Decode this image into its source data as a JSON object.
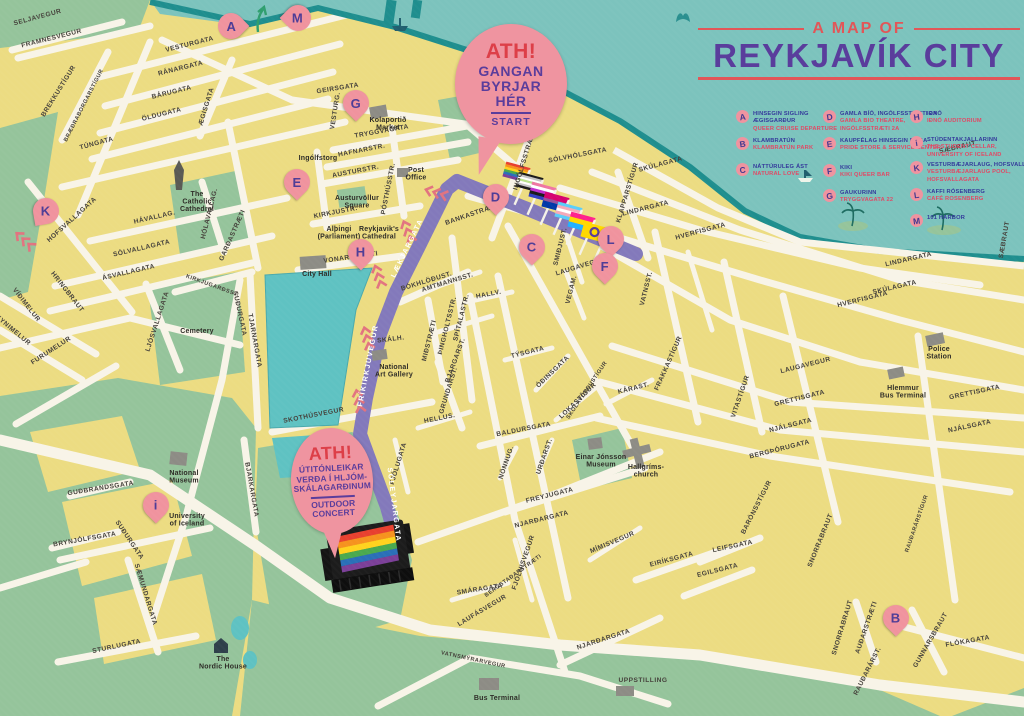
{
  "title": {
    "pre": "A MAP OF",
    "main": "REYKJAVÍK CITY"
  },
  "callouts": {
    "start": {
      "ath": "ATH!",
      "l1": "GANGAN",
      "l2": "BYRJAR",
      "l3": "HÉR",
      "foot": "START"
    },
    "concert": {
      "ath": "ATH!",
      "l1": "ÚTITÓNLEIKAR",
      "l2": "VERÐA Í HLJÓM-",
      "l3": "SKÁLAGARÐINUM",
      "f1": "OUTDOOR",
      "f2": "CONCERT"
    }
  },
  "legend": {
    "entries": [
      {
        "letter": "A",
        "x": 736,
        "y": 110,
        "is": [
          "HINSEGIN SIGLING",
          "ÆGISGARÐUR"
        ],
        "en": [
          "QUEER CRUISE DEPARTURE"
        ]
      },
      {
        "letter": "B",
        "x": 736,
        "y": 137,
        "is": [
          "KLAMBRATÚN"
        ],
        "en": [
          "KLAMBRATÚN PARK"
        ]
      },
      {
        "letter": "C",
        "x": 736,
        "y": 163,
        "is": [
          "NÁTTÚRULEG ÁST"
        ],
        "en": [
          "NATURAL LOVE"
        ]
      },
      {
        "letter": "D",
        "x": 823,
        "y": 110,
        "is": [
          "GAMLA BÍÓ, INGÓLFSSTRÆTI 2A"
        ],
        "en": [
          "GAMLA BIO THEATRE,",
          "INGÓLFSSTRÆTI 2A"
        ]
      },
      {
        "letter": "E",
        "x": 823,
        "y": 137,
        "is": [
          "KAUPFÉLAG HINSEGIN DAGA"
        ],
        "en": [
          "PRIDE STORE & SERVICE CENTER"
        ]
      },
      {
        "letter": "F",
        "x": 823,
        "y": 164,
        "is": [
          "KIKI"
        ],
        "en": [
          "KIKI QUEER BAR"
        ]
      },
      {
        "letter": "G",
        "x": 823,
        "y": 189,
        "is": [
          "GAUKURINN"
        ],
        "en": [
          "TRYGGVAGATA 22"
        ]
      },
      {
        "letter": "H",
        "x": 910,
        "y": 110,
        "is": [
          "IÐNÓ"
        ],
        "en": [
          "IÐNÓ AUDITORIUM"
        ]
      },
      {
        "letter": "i",
        "x": 910,
        "y": 136,
        "is": [
          "STÚDENTAKJALLARINN"
        ],
        "en": [
          "THE STUDENT CELLAR,",
          "UNIVERSITY OF ICELAND"
        ]
      },
      {
        "letter": "K",
        "x": 910,
        "y": 161,
        "is": [
          "VESTURBÆJARLAUG, HOFSVALLAGATA"
        ],
        "en": [
          "VESTURBÆJARLAUG POOL,",
          "HOFSVALLAGATA"
        ]
      },
      {
        "letter": "L",
        "x": 910,
        "y": 188,
        "is": [
          "KAFFI RÓSENBERG"
        ],
        "en": [
          "CAFÉ ROSENBERG"
        ]
      },
      {
        "letter": "M",
        "x": 910,
        "y": 214,
        "is": [
          "101 HARBOR"
        ],
        "en": []
      }
    ]
  },
  "map": {
    "pins": [
      [
        "A",
        231,
        26,
        "right"
      ],
      [
        "M",
        298,
        18,
        "left"
      ],
      [
        "G",
        356,
        103,
        "down"
      ],
      [
        "E",
        297,
        182,
        "down"
      ],
      [
        "H",
        361,
        252,
        "down"
      ],
      [
        "D",
        496,
        197,
        "down"
      ],
      [
        "C",
        532,
        247,
        "down"
      ],
      [
        "L",
        611,
        239,
        "down"
      ],
      [
        "F",
        605,
        266,
        "down"
      ],
      [
        "K",
        46,
        211,
        "down-left"
      ],
      [
        "i",
        156,
        505,
        "down"
      ],
      [
        "B",
        896,
        618,
        "down"
      ]
    ],
    "route_labels": [
      [
        "LÆKJARGATA",
        409,
        249,
        -64
      ],
      [
        "FRÍKIRKJUVEGUR",
        370,
        366,
        -79
      ],
      [
        "SÓLEYJARGATA",
        392,
        505,
        83
      ]
    ],
    "street_labels": [
      [
        "SELJAVEGUR",
        38,
        19,
        -15
      ],
      [
        "FRAMNESVEGUR",
        52,
        40,
        -14
      ],
      [
        "VESTURGATA",
        190,
        46,
        -14
      ],
      [
        "RÁNARGATA",
        181,
        70,
        -14
      ],
      [
        "BÁRUGATA",
        172,
        94,
        -14
      ],
      [
        "ÖLDUGATA",
        162,
        116,
        -14
      ],
      [
        "ÆGISGATA",
        208,
        107,
        -73
      ],
      [
        "BREKKUSTÍGUR",
        60,
        92,
        -58
      ],
      [
        "BRÆÐRABORGARSTÍGUR",
        85,
        106,
        -63
      ],
      [
        "TÚNGATA",
        97,
        145,
        -15
      ],
      [
        "HOFSVALLAGATA",
        73,
        221,
        -42
      ],
      [
        "HÁVALLAG.",
        155,
        219,
        -13
      ],
      [
        "HÓLAVALLAG.",
        211,
        214,
        -76
      ],
      [
        "GARÐASTRÆTI",
        234,
        236,
        -66
      ],
      [
        "SÓLVALLAGATA",
        142,
        250,
        -13
      ],
      [
        "ÁSVALLAGATA",
        129,
        274,
        -13
      ],
      [
        "LJÓSVALLAGATA",
        159,
        322,
        -72
      ],
      [
        "KIRKJUGARÐSST.",
        212,
        287,
        20
      ],
      [
        "SUÐURGATA",
        238,
        314,
        78
      ],
      [
        "TJARNARGATA",
        253,
        341,
        80
      ],
      [
        "VÍÐIMELUR",
        25,
        306,
        52
      ],
      [
        "REYNIMELUR",
        10,
        330,
        40
      ],
      [
        "FURUMELUR",
        52,
        352,
        -33
      ],
      [
        "HRINGBRAUT",
        66,
        293,
        52
      ],
      [
        "GEIRSGATA",
        338,
        90,
        -9
      ],
      [
        "TRYGGVAGATA",
        382,
        133,
        -10
      ],
      [
        "HAFNARSTR.",
        362,
        152,
        -11
      ],
      [
        "AUSTURSTR.",
        356,
        173,
        -11
      ],
      [
        "PÓSTHÚSSTR.",
        390,
        189,
        -79
      ],
      [
        "VESTURG.",
        337,
        111,
        -81
      ],
      [
        "KIRKJUSTR.",
        336,
        214,
        -11
      ],
      [
        "VONARSTRÆTI",
        351,
        259,
        -8
      ],
      [
        "INGÓLFSSTRÆTI",
        526,
        161,
        -73
      ],
      [
        "SÓLVHÓLSGATA",
        578,
        157,
        -11
      ],
      [
        "SKÚLAGATA",
        661,
        166,
        -15
      ],
      [
        "SKÚLAGATA",
        895,
        289,
        -13
      ],
      [
        "SÆBRAUT",
        958,
        149,
        -13
      ],
      [
        "SÆBRAUT",
        1006,
        240,
        -80
      ],
      [
        "LINDARGATA",
        646,
        210,
        -14
      ],
      [
        "LINDARGATA",
        909,
        261,
        -13
      ],
      [
        "HVERFISGATA",
        701,
        233,
        -15
      ],
      [
        "HVERFISGATA",
        863,
        301,
        -14
      ],
      [
        "KLAPPARSTÍGUR",
        629,
        193,
        -73
      ],
      [
        "BANKASTRÆTI",
        472,
        216,
        -19
      ],
      [
        "AMTMANNSST.",
        448,
        284,
        -17
      ],
      [
        "SMIÐJUST.",
        562,
        247,
        -76
      ],
      [
        "LAUGAVEGUR",
        581,
        268,
        -17
      ],
      [
        "LAUGAVEGUR",
        806,
        367,
        -14
      ],
      [
        "VEGAM.",
        573,
        290,
        -76
      ],
      [
        "VATNSST.",
        648,
        289,
        -76
      ],
      [
        "HALLV.",
        489,
        296,
        -11
      ],
      [
        "SKÓLAVÖRÐUSTÍGUR",
        588,
        391,
        -56
      ],
      [
        "ÞINGHOLTSSTR.",
        449,
        326,
        -76
      ],
      [
        "MIÐSTRÆTI",
        431,
        341,
        -76
      ],
      [
        "SPÍTALASTR.",
        463,
        318,
        -76
      ],
      [
        "BÓKHLÖÐUST.",
        427,
        283,
        -17
      ],
      [
        "BJARGARST.",
        457,
        361,
        -70
      ],
      [
        "GRUNDARST.",
        450,
        391,
        -73
      ],
      [
        "HELLUS.",
        440,
        420,
        -11
      ],
      [
        "SKÁLH.",
        391,
        341,
        -7
      ],
      [
        "SKOTHÚSVEGUR",
        314,
        417,
        -11
      ],
      [
        "TÝSGATA",
        528,
        354,
        -14
      ],
      [
        "ÓÐINSGATA",
        554,
        373,
        -44
      ],
      [
        "LOKASTÍGUR",
        579,
        402,
        -44
      ],
      [
        "BALDURSGATA",
        524,
        431,
        -11
      ],
      [
        "NÖNNUG.",
        508,
        463,
        -71
      ],
      [
        "URÐARST.",
        546,
        457,
        -71
      ],
      [
        "FREYJUGATA",
        550,
        497,
        -14
      ],
      [
        "NJARÐARGATA",
        542,
        521,
        -14
      ],
      [
        "NJARÐARGATA",
        604,
        641,
        -18
      ],
      [
        "FJÓLUGATA",
        400,
        464,
        -73
      ],
      [
        "FJÖLNISVEGUR",
        525,
        563,
        -71
      ],
      [
        "SMÁRAGATA",
        480,
        591,
        -9
      ],
      [
        "LAUFÁSVEGUR",
        483,
        612,
        -31
      ],
      [
        "BERGSTAÐARSTRÆTI",
        514,
        577,
        -36
      ],
      [
        "MÍMISVEGUR",
        613,
        544,
        -23
      ],
      [
        "EIRÍKSGATA",
        672,
        561,
        -15
      ],
      [
        "EGILSGATA",
        718,
        572,
        -14
      ],
      [
        "LEIFSGATA",
        733,
        548,
        -12
      ],
      [
        "BARÓNSSTÍGUR",
        758,
        508,
        -63
      ],
      [
        "SNORRABRAUT",
        822,
        541,
        -68
      ],
      [
        "SNORRABRAUT",
        844,
        628,
        -73
      ],
      [
        "RAUÐARÁRSTÍGUR",
        918,
        524,
        -71
      ],
      [
        "RAUÐARÁRST.",
        869,
        672,
        -63
      ],
      [
        "GUNNARSBRAUT",
        932,
        641,
        -60
      ],
      [
        "AUÐARSTRÆTI",
        868,
        628,
        -71
      ],
      [
        "FLÓKAGATA",
        968,
        643,
        -10
      ],
      [
        "KÁRAST.",
        634,
        390,
        -14
      ],
      [
        "FRAKKASTÍGUR",
        670,
        364,
        -66
      ],
      [
        "VITASTÍGUR",
        742,
        397,
        -71
      ],
      [
        "GRETTISGATA",
        800,
        400,
        -14
      ],
      [
        "GRETTISGATA",
        975,
        394,
        -12
      ],
      [
        "NJÁLSGATA",
        791,
        427,
        -14
      ],
      [
        "NJÁLSGATA",
        970,
        428,
        -12
      ],
      [
        "BERGÞÓRUGATA",
        780,
        451,
        -14
      ],
      [
        "VATNSMÝRARVEGUR",
        473,
        661,
        12
      ],
      [
        "UPPSTILLING",
        643,
        682,
        0
      ],
      [
        "STURLUGATA",
        117,
        648,
        -12
      ],
      [
        "SÆMUNDARGATA",
        144,
        595,
        73
      ],
      [
        "BRYNJÓLFSGATA",
        85,
        541,
        -10
      ],
      [
        "GUÐBRANDSGATA",
        101,
        490,
        -9
      ],
      [
        "SUÐURGATA",
        128,
        541,
        56
      ],
      [
        "BJARKARGATA",
        250,
        490,
        80
      ]
    ],
    "landmarks": [
      [
        "Kolaportið|Market",
        388,
        122
      ],
      [
        "Post|Office",
        416,
        172
      ],
      [
        "Ingólfstorg",
        318,
        160
      ],
      [
        "Austurvöllur|Square",
        357,
        200
      ],
      [
        "Alþingi|(Parliament)",
        339,
        231
      ],
      [
        "Reykjavik's|Cathedral",
        379,
        231
      ],
      [
        "City Hall",
        317,
        276
      ],
      [
        "National|Art Gallery",
        394,
        369
      ],
      [
        "The|Catholic|Cathedral",
        197,
        196
      ],
      [
        "Cemetery",
        197,
        333
      ],
      [
        "Hallgríms-|church",
        646,
        469
      ],
      [
        "Einar Jónsson|Museum",
        601,
        459
      ],
      [
        "Police|Station",
        939,
        351
      ],
      [
        "Hlemmur|Bus Terminal",
        903,
        390
      ],
      [
        "National|Museum",
        184,
        475
      ],
      [
        "University|of Iceland",
        187,
        518
      ],
      [
        "The|Nordic House",
        223,
        661
      ],
      [
        "Bus Terminal",
        497,
        700
      ]
    ],
    "chevrons": [
      [
        447,
        196,
        197
      ],
      [
        412,
        242,
        248
      ],
      [
        382,
        287,
        252
      ],
      [
        370,
        349,
        255
      ],
      [
        361,
        412,
        258
      ],
      [
        33,
        248,
        222
      ]
    ],
    "flags": [
      {
        "n": "rainbow",
        "s": [
          "#e8402f",
          "#f6921e",
          "#ffd21e",
          "#4aa94e",
          "#2a6fb8",
          "#7b3f98"
        ]
      },
      {
        "n": "agender",
        "s": [
          "#1b1b1b",
          "#c3c3c3",
          "#ffffff",
          "#b9e28c",
          "#ffffff",
          "#c3c3c3",
          "#1b1b1b"
        ]
      },
      {
        "n": "genderfluid",
        "s": [
          "#ef76a3",
          "#ffffff",
          "#bf2fcf",
          "#1b1b1b",
          "#333ec4"
        ]
      },
      {
        "n": "bisexual",
        "s": [
          "#d6026f",
          "#d6026f",
          "#96509b",
          "#0038a8",
          "#0038a8"
        ]
      },
      {
        "n": "transgender",
        "s": [
          "#5bcefa",
          "#f5a9b8",
          "#ffffff",
          "#f5a9b8",
          "#5bcefa"
        ]
      },
      {
        "n": "pansexual",
        "s": [
          "#ff218c",
          "#ffd800",
          "#21b1ff"
        ]
      },
      {
        "n": "intersex",
        "s": [
          "#ffd800"
        ],
        "ring": true
      }
    ],
    "stage_stripes": [
      "#e8402f",
      "#f6921e",
      "#ffd21e",
      "#4aa94e",
      "#2a6fb8",
      "#7b3f98"
    ]
  },
  "colors": {
    "sea": "#7cc3bd",
    "coast": "#1f8e8e",
    "land_green": "#a7c9a2",
    "park": "#95c49b",
    "blocks": "#ecdc82",
    "street": "#f8f4e8",
    "lake": "#5fc2c2",
    "route": "#8379bb",
    "pin": "#f0939e",
    "pin_letter": "#4e3c96",
    "title_red": "#e25658",
    "title_purple": "#5a3d9c",
    "legend_navy": "#34399b",
    "legend_red": "#e04a66"
  }
}
